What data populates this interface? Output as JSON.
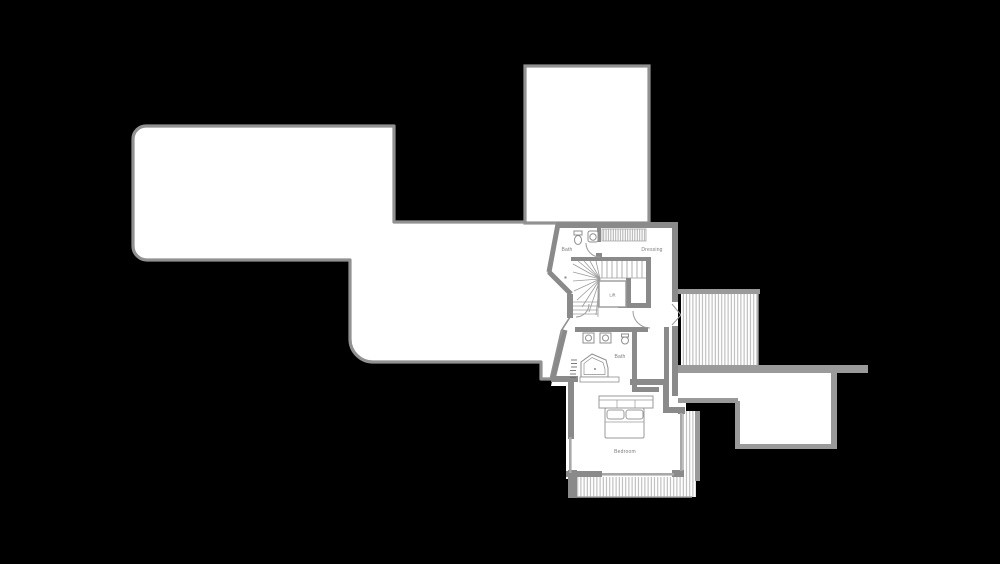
{
  "figure": {
    "kind": "architectural-floor-plan",
    "storey": "upper floor with roof outlines and decks"
  },
  "colors": {
    "background": "#000000",
    "shape_fill": "#ffffff",
    "shape_outline": "#919191",
    "wall": "#8a8a8a",
    "thin_line": "#a8a8a8",
    "hatch_line": "#b5b5b5",
    "deck_border": "#9a9a9a",
    "label_text": "#7d7d7d"
  },
  "plan": {
    "rooms": {
      "bath_upper": "Bath",
      "dressing": "Dressing",
      "lift": "Lift",
      "bath_lower": "Bath",
      "bedroom": "Bedroom"
    }
  }
}
